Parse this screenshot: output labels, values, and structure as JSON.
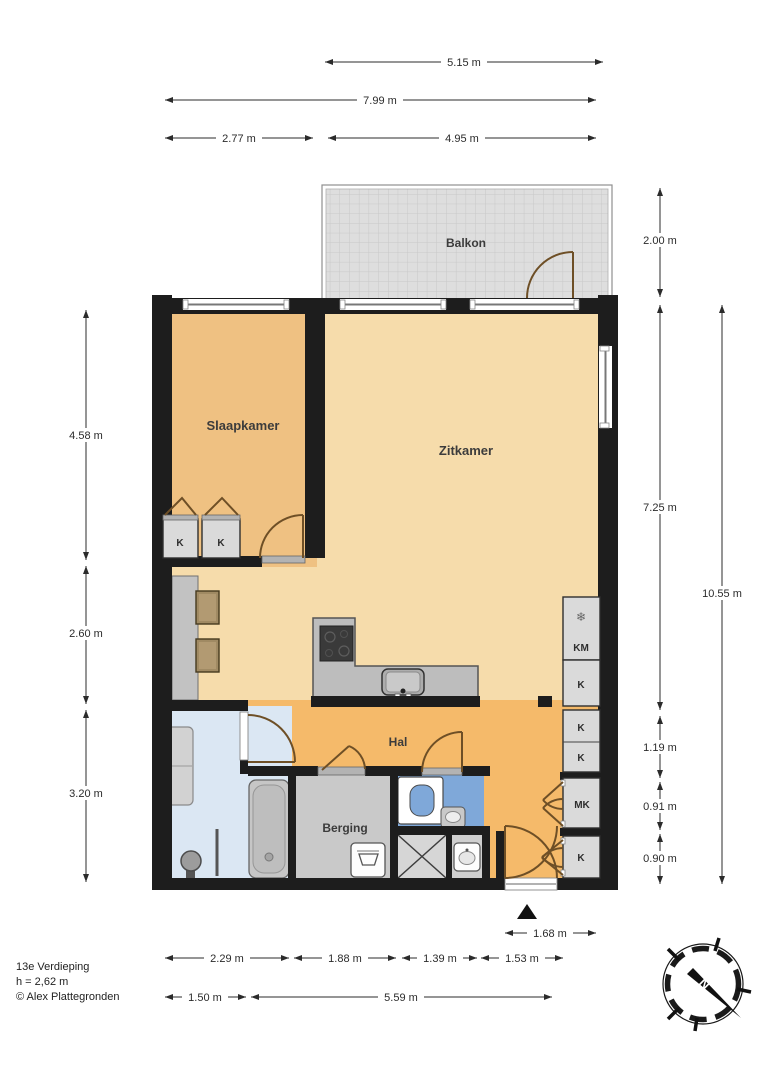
{
  "colors": {
    "wall": "#1d1d1d",
    "zitkamer_floor": "#f6dcab",
    "slaapkamer_floor": "#efc182",
    "hal_floor": "#f5ba6a",
    "bathroom_floor": "#dbe7f3",
    "wc_floor": "#7fa8d9",
    "berging_floor": "#c9c9c9",
    "balcony_floor": "#dedede",
    "door_swing": "#6e4f26",
    "dimension": "#2b2b2b"
  },
  "rooms": {
    "balkon": "Balkon",
    "slaapkamer": "Slaapkamer",
    "zitkamer": "Zitkamer",
    "hal": "Hal",
    "berging": "Berging"
  },
  "closets": {
    "k": "K",
    "km": "KM",
    "mk": "MK"
  },
  "icons": {
    "snowflake": "❄"
  },
  "dimensions": {
    "top_515": "5.15 m",
    "top_799": "7.99 m",
    "top_277": "2.77 m",
    "top_495": "4.95 m",
    "left_458": "4.58 m",
    "left_260": "2.60 m",
    "left_320": "3.20 m",
    "right_200": "2.00 m",
    "right_725": "7.25 m",
    "right_1055": "10.55 m",
    "right_119": "1.19 m",
    "right_091": "0.91 m",
    "right_090": "0.90 m",
    "bottom_168": "1.68 m",
    "bottom_229": "2.29 m",
    "bottom_188": "1.88 m",
    "bottom_139": "1.39 m",
    "bottom_153": "1.53 m",
    "bottom_150": "1.50 m",
    "bottom_559": "5.59 m"
  },
  "compass": {
    "north": "N"
  },
  "footer": {
    "floor": "13e Verdieping",
    "ceiling_height": "h = 2,62 m",
    "copyright": "© Alex Plattegronden"
  }
}
